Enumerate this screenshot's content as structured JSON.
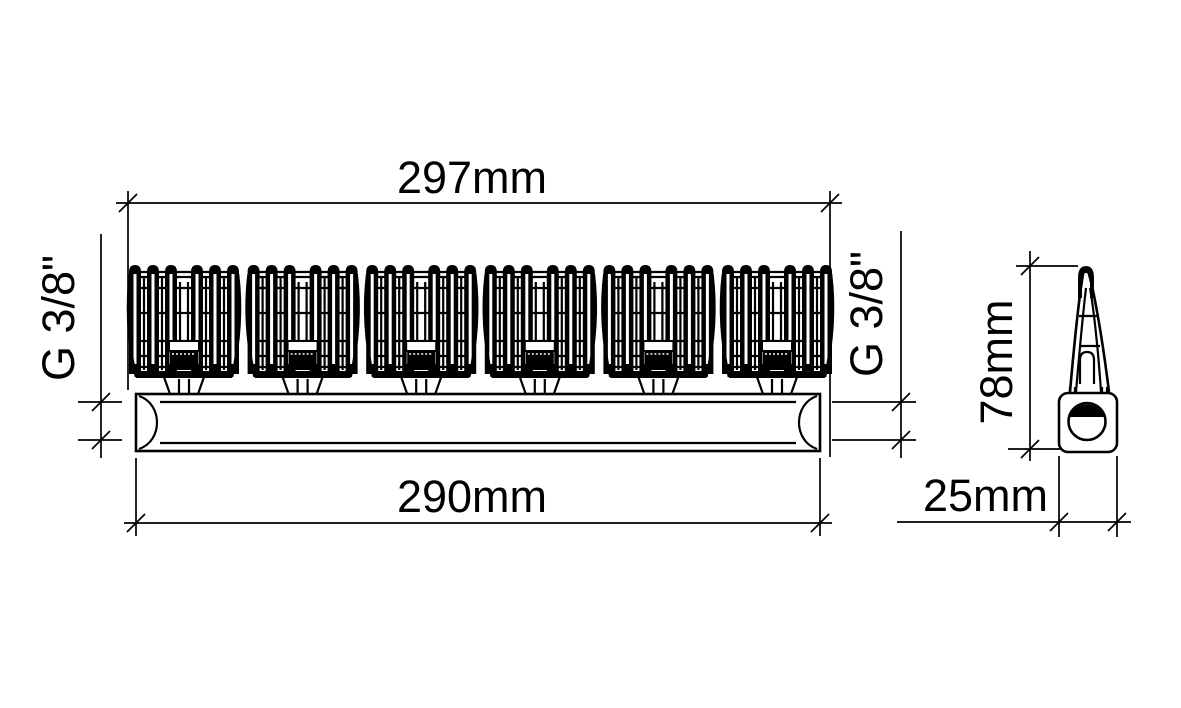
{
  "sheet": {
    "background": "#ffffff",
    "line_color": "#000000",
    "description": "Technical dimension drawing of a brush manifold bar, front view and side view"
  },
  "front_view": {
    "name": "front-view",
    "element_count": 6,
    "dims": {
      "overall_width": "297mm",
      "body_length": "290mm",
      "thread_left": "G 3/8\"",
      "thread_right": "G 3/8\""
    }
  },
  "side_view": {
    "name": "side-view",
    "dims": {
      "height": "78mm",
      "depth": "25mm"
    }
  }
}
